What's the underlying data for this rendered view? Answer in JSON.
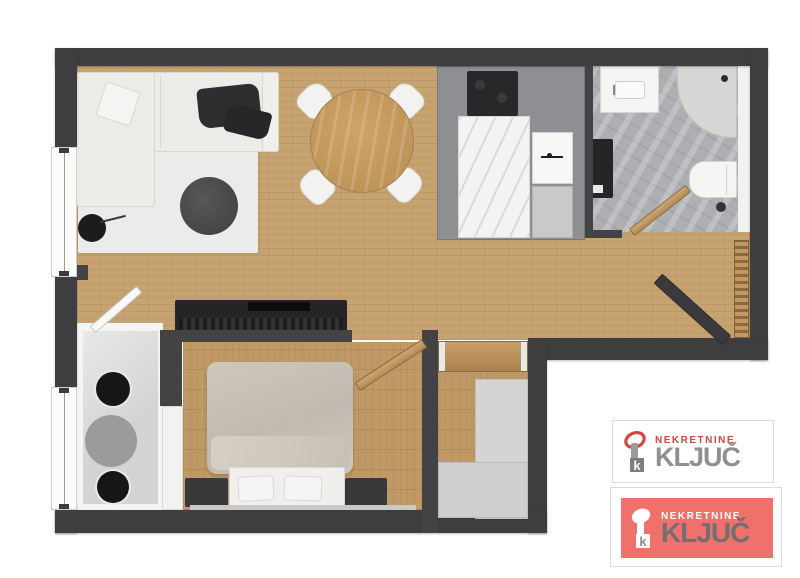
{
  "watermark": {
    "logos": [
      {
        "brand_top": "NEKRETNINE",
        "brand_main": "KLJUČ",
        "key_letter": "k",
        "variant": "white-card",
        "colors": {
          "background": "#ffffff",
          "brand_top": "#d8453f",
          "brand_main": "#8e8f91",
          "key_head": "#d8453f",
          "key_stem": "#9a9b9d",
          "key_square": "#7c7d7f"
        }
      },
      {
        "brand_top": "NEKRETNINE",
        "brand_main": "KLJUČ",
        "key_letter": "k",
        "variant": "red-card",
        "colors": {
          "background": "#f0716c",
          "brand_top": "#ffffff",
          "brand_main": "#6f7072",
          "key": "#ffffff"
        }
      }
    ]
  },
  "floor_plan": {
    "type": "apartment-top-view-3d-render",
    "rooms": [
      "living-room",
      "dining-area",
      "kitchen",
      "bathroom",
      "hallway",
      "bedroom",
      "wc",
      "closet"
    ],
    "furniture": [
      "corner-sofa",
      "sofa-pillow",
      "sofa-blanket",
      "area-rug",
      "round-rug",
      "side-table",
      "tv-sideboard",
      "tv",
      "dining-table",
      "dining-chairs-4",
      "cooktop",
      "kitchen-counter",
      "oven",
      "kitchen-cabinet",
      "bathroom-vanity",
      "corner-shower",
      "toilet",
      "washer-column",
      "double-bed",
      "pillows",
      "nightstands",
      "white-wardrobe",
      "hall-console",
      "hall-closet",
      "radiator",
      "entrance-door",
      "bedroom-door",
      "bathroom-door",
      "wc-door",
      "windows"
    ],
    "colors": {
      "walls": "#3e3e40",
      "floor_wood": "#c6a271",
      "bedroom_wood": "#bf9a67",
      "kitchen_gray": "#8d8f92",
      "bath_tile": "#adafb2",
      "wc_tile": "#dcdcda",
      "rug": "#ebebe9",
      "accent_dark": "#252527"
    }
  }
}
